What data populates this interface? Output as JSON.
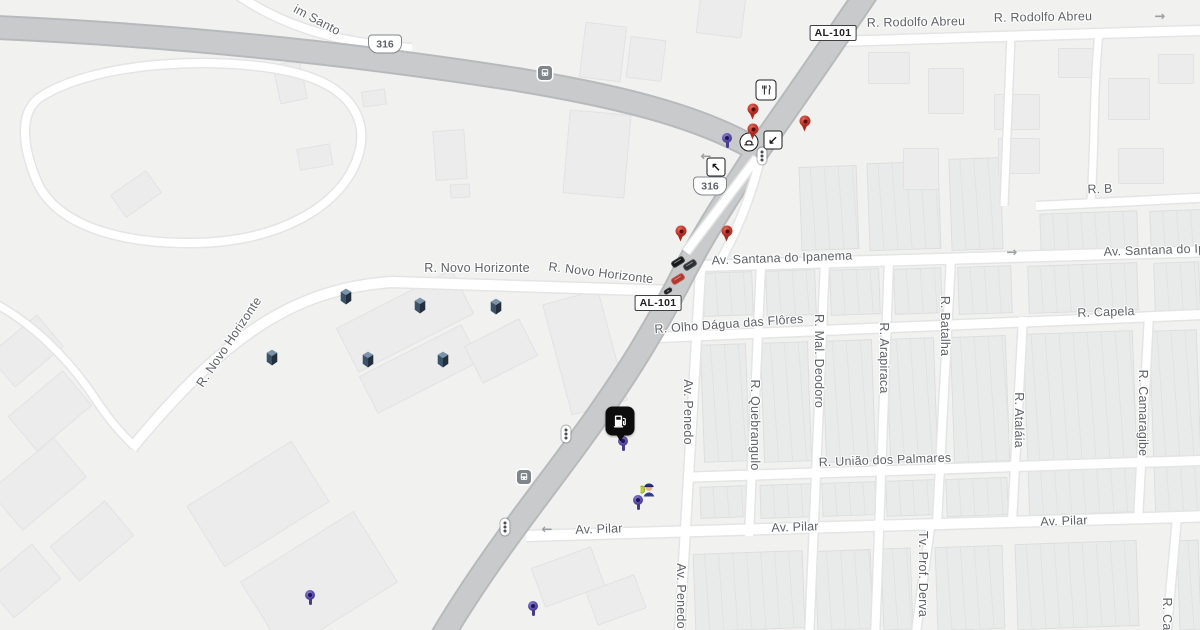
{
  "map": {
    "background_color": "#f1f2f0",
    "highway_color": "#c8cacb",
    "highway_casing_color": "#b7babc",
    "street_color": "#ffffff",
    "street_casing_color": "#e3e5e4",
    "label_color": "#5f6368",
    "red_pin_color": "#c0392f",
    "purple_pin_color": "#5448a0",
    "building_icon_color": "#3c5268"
  },
  "street_labels": [
    {
      "id": "jardim-santo",
      "text": "im Santo",
      "x": 317,
      "y": 20,
      "rot": 28
    },
    {
      "id": "rodolfo-abreu-1",
      "text": "R. Rodolfo Abreu",
      "x": 916,
      "y": 22,
      "rot": -1
    },
    {
      "id": "rodolfo-abreu-2",
      "text": "R. Rodolfo Abreu",
      "x": 1043,
      "y": 17,
      "rot": -1
    },
    {
      "id": "r-b",
      "text": "R. B",
      "x": 1100,
      "y": 189,
      "rot": -2
    },
    {
      "id": "santana-do-ipanema-1",
      "text": "Av. Santana do Ipanema",
      "x": 782,
      "y": 258,
      "rot": -2
    },
    {
      "id": "santana-do-ipanema-2",
      "text": "Av. Santana do Ipa",
      "x": 1158,
      "y": 250,
      "rot": -2
    },
    {
      "id": "novo-horizonte-1",
      "text": "R. Novo Horizonte",
      "x": 477,
      "y": 268,
      "rot": 0
    },
    {
      "id": "novo-horizonte-2",
      "text": "R. Novo Horizonte",
      "x": 601,
      "y": 273,
      "rot": 7
    },
    {
      "id": "novo-horizonte-3",
      "text": "R. Novo Horizonte",
      "x": 229,
      "y": 342,
      "rot": -56
    },
    {
      "id": "olho-dagua-das-flores",
      "text": "R. Olho Dágua das Flôres",
      "x": 729,
      "y": 324,
      "rot": -4
    },
    {
      "id": "capela",
      "text": "R. Capela",
      "x": 1106,
      "y": 312,
      "rot": -2
    },
    {
      "id": "uniao-dos-palmares",
      "text": "R. União dos Palmares",
      "x": 885,
      "y": 460,
      "rot": -2
    },
    {
      "id": "pilar-1",
      "text": "Av. Pilar",
      "x": 599,
      "y": 529,
      "rot": -2
    },
    {
      "id": "pilar-2",
      "text": "Av. Pilar",
      "x": 795,
      "y": 527,
      "rot": -2
    },
    {
      "id": "pilar-3",
      "text": "Av. Pilar",
      "x": 1064,
      "y": 521,
      "rot": -2
    },
    {
      "id": "penedo-1",
      "text": "Av. Penedo",
      "x": 688,
      "y": 412,
      "rot": 90
    },
    {
      "id": "penedo-2",
      "text": "Av. Penedo",
      "x": 681,
      "y": 596,
      "rot": 90
    },
    {
      "id": "quebrangulo",
      "text": "R. Quebrangulo",
      "x": 755,
      "y": 425,
      "rot": 90
    },
    {
      "id": "mal-deodoro",
      "text": "R. Mal. Deodoro",
      "x": 819,
      "y": 361,
      "rot": 90
    },
    {
      "id": "arapiraca",
      "text": "R. Arapiraca",
      "x": 884,
      "y": 358,
      "rot": 90
    },
    {
      "id": "batalha",
      "text": "R. Batalha",
      "x": 945,
      "y": 326,
      "rot": 90
    },
    {
      "id": "atalaia",
      "text": "R. Ataláia",
      "x": 1019,
      "y": 420,
      "rot": 90
    },
    {
      "id": "camaragibe",
      "text": "R. Camaragibe",
      "x": 1143,
      "y": 413,
      "rot": 90
    },
    {
      "id": "tv-prof-derva",
      "text": "Tv. Prof. Derva",
      "x": 923,
      "y": 574,
      "rot": 90
    },
    {
      "id": "r-ca",
      "text": "R. Ca",
      "x": 1167,
      "y": 614,
      "rot": 90
    }
  ],
  "route_shields": [
    {
      "label": "316",
      "x": 385,
      "y": 44
    },
    {
      "label": "316",
      "x": 710,
      "y": 186
    }
  ],
  "highway_badges": [
    {
      "label": "AL-101",
      "x": 833,
      "y": 33
    },
    {
      "label": "AL-101",
      "x": 658,
      "y": 303
    }
  ],
  "markers": {
    "red_pins": [
      {
        "x": 753,
        "y": 109
      },
      {
        "x": 753,
        "y": 129
      },
      {
        "x": 805,
        "y": 121
      },
      {
        "x": 681,
        "y": 231
      },
      {
        "x": 727,
        "y": 231
      }
    ],
    "purple_pins": [
      {
        "x": 727,
        "y": 138
      },
      {
        "x": 623,
        "y": 441
      },
      {
        "x": 638,
        "y": 500
      },
      {
        "x": 533,
        "y": 606
      },
      {
        "x": 310,
        "y": 595
      }
    ],
    "gas_station": {
      "x": 620,
      "y": 421,
      "icon": "fuel-pump-icon"
    },
    "restaurant": {
      "x": 766,
      "y": 90,
      "icon": "restaurant-icon"
    },
    "bus_stops": [
      {
        "x": 545,
        "y": 73
      },
      {
        "x": 524,
        "y": 477
      }
    ],
    "traffic_lights": [
      {
        "x": 762,
        "y": 156
      },
      {
        "x": 566,
        "y": 434
      },
      {
        "x": 505,
        "y": 527
      }
    ],
    "junction": {
      "x": 749,
      "y": 142,
      "icon": "overpass-icon"
    },
    "turn_arrows": [
      {
        "x": 773,
        "y": 140,
        "glyph": "↙"
      },
      {
        "x": 716,
        "y": 167,
        "glyph": "↖"
      }
    ],
    "one_way_arrows": [
      {
        "x": 1160,
        "y": 17,
        "glyph": "→"
      },
      {
        "x": 1012,
        "y": 253,
        "glyph": "→"
      },
      {
        "x": 547,
        "y": 530,
        "glyph": "←"
      },
      {
        "x": 706,
        "y": 157,
        "glyph": "←"
      }
    ],
    "vehicles": [
      {
        "x": 678,
        "y": 262,
        "color": "#17181a",
        "size": "normal"
      },
      {
        "x": 690,
        "y": 265,
        "color": "#2a2d31",
        "size": "normal"
      },
      {
        "x": 678,
        "y": 279,
        "color": "#b5342c",
        "size": "normal"
      },
      {
        "x": 668,
        "y": 291,
        "color": "#1c1d1f",
        "size": "small"
      }
    ],
    "police_officer": {
      "x": 649,
      "y": 491,
      "icon": "police-officer-icon"
    },
    "buildings_3d": [
      {
        "x": 346,
        "y": 298
      },
      {
        "x": 420,
        "y": 307
      },
      {
        "x": 496,
        "y": 308
      },
      {
        "x": 272,
        "y": 359
      },
      {
        "x": 368,
        "y": 361
      },
      {
        "x": 443,
        "y": 361
      }
    ]
  },
  "icons": {
    "fuel-pump-icon": "gas station marker",
    "restaurant-icon": "fork and knife",
    "bus-stop-icon": "bus",
    "traffic-light-icon": "traffic signal",
    "overpass-icon": "grade junction",
    "turn-arrow-icon": "turn arrow",
    "one-way-arrow-icon": "one way direction",
    "map-pin-red-icon": "red place pin",
    "map-pin-purple-icon": "purple place pin",
    "police-officer-icon": "police officer",
    "building-3d-icon": "navy 3d building"
  }
}
